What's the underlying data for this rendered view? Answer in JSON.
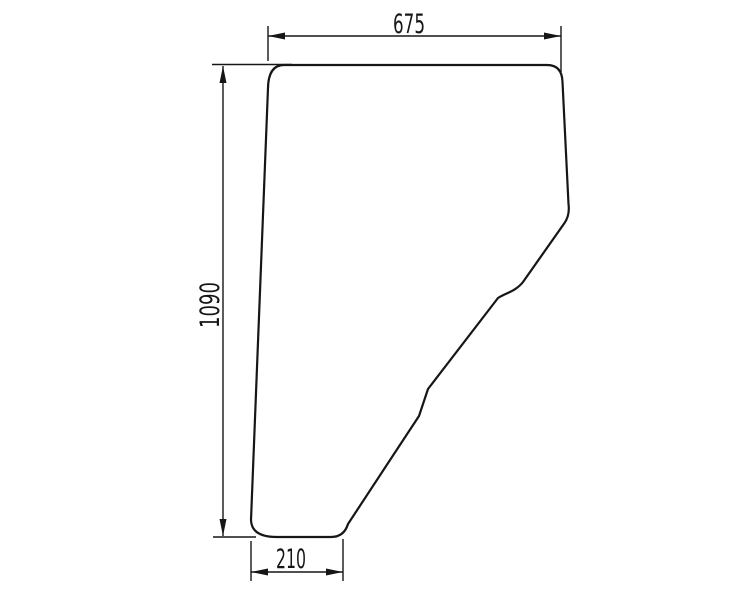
{
  "drawing": {
    "subject": "door-glass-panel-outline",
    "background": "#ffffff",
    "line_color": "#161616",
    "dimensions": {
      "top_width": "675",
      "left_height": "1090",
      "bottom_width": "210"
    }
  }
}
